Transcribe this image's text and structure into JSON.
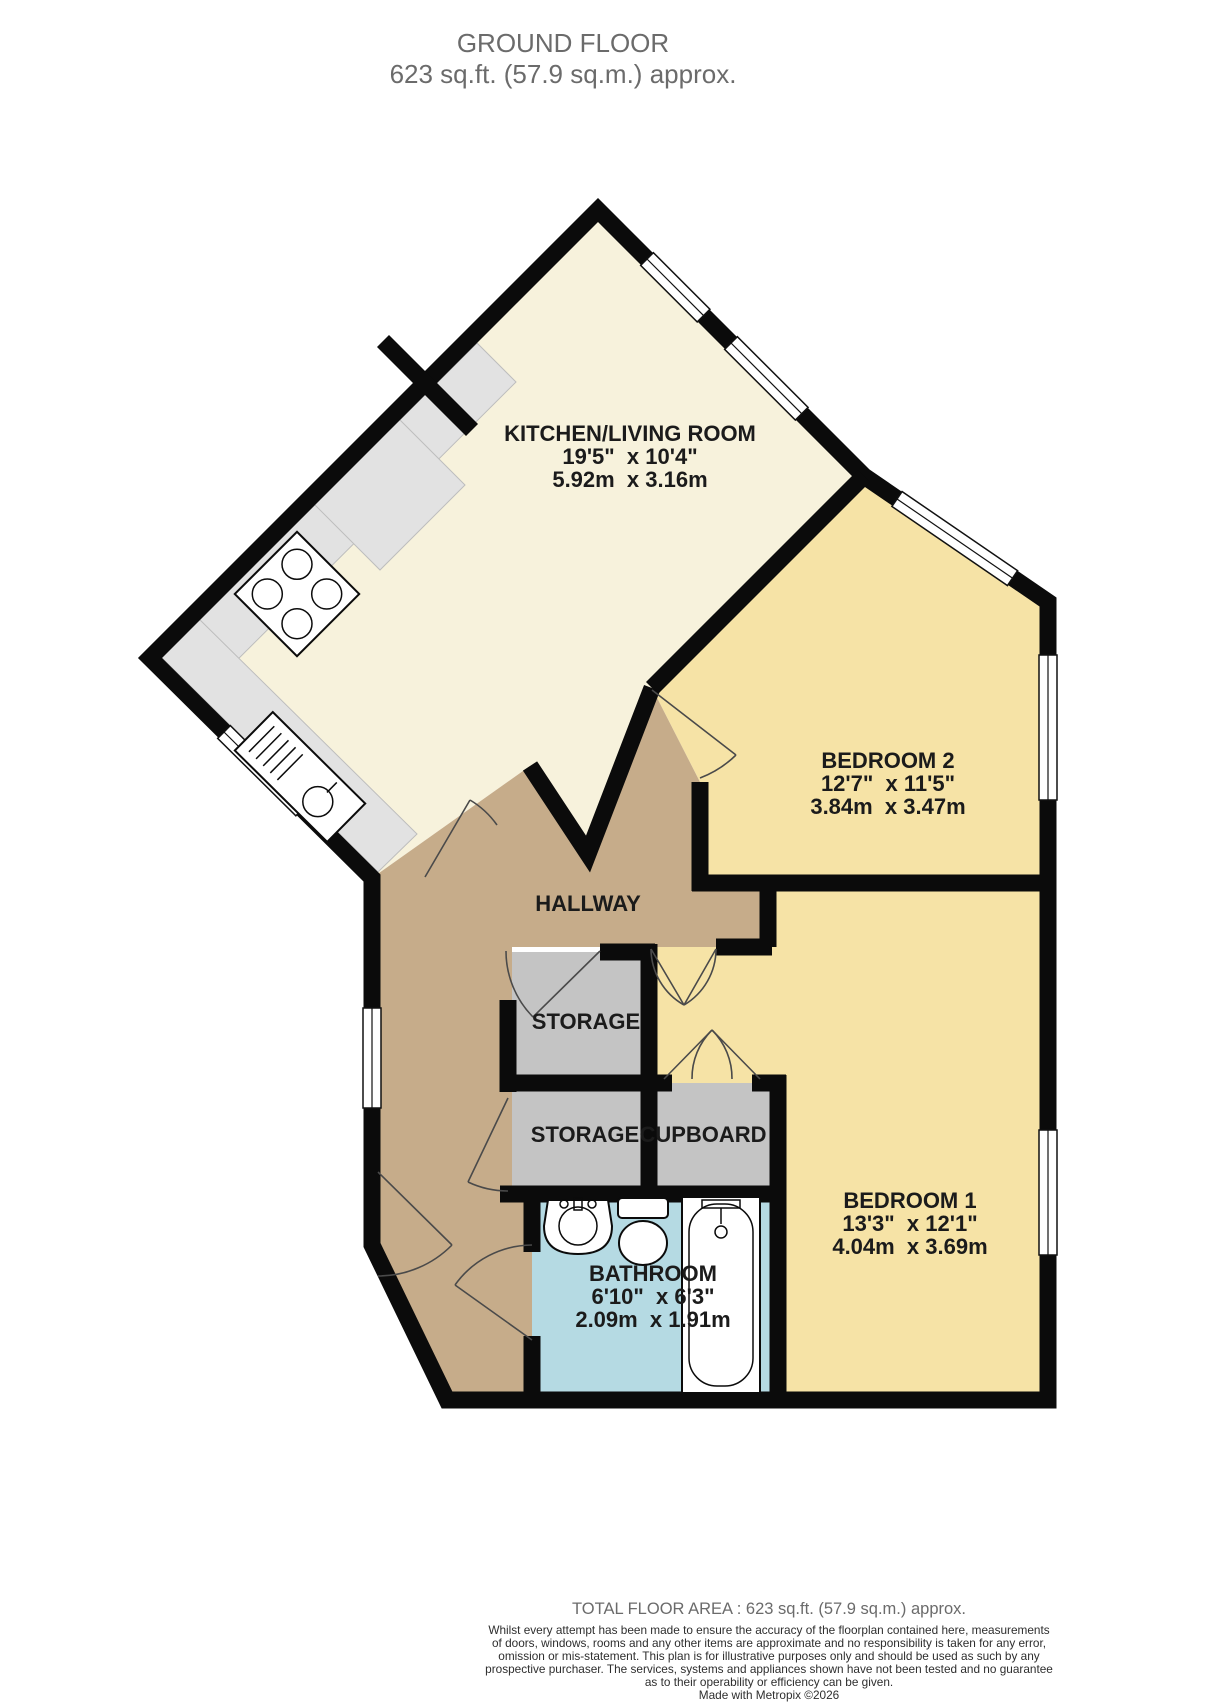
{
  "title": {
    "line1": "GROUND FLOOR",
    "line2": "623 sq.ft. (57.9 sq.m.) approx."
  },
  "rooms": {
    "kitchen_living": {
      "name": "KITCHEN/LIVING ROOM",
      "imperial": "19'5\"  x 10'4\"",
      "metric": "5.92m  x 3.16m"
    },
    "bedroom2": {
      "name": "BEDROOM 2",
      "imperial": "12'7\"  x 11'5\"",
      "metric": "3.84m  x 3.47m"
    },
    "hallway": {
      "name": "HALLWAY"
    },
    "storage1": {
      "name": "STORAGE"
    },
    "storage2": {
      "name": "STORAGE"
    },
    "cupboard": {
      "name": "CUPBOARD"
    },
    "bathroom": {
      "name": "BATHROOM",
      "imperial": "6'10\"  x 6'3\"",
      "metric": "2.09m  x 1.91m"
    },
    "bedroom1": {
      "name": "BEDROOM 1",
      "imperial": "13'3\"  x 12'1\"",
      "metric": "4.04m  x 3.69m"
    }
  },
  "footer": {
    "total": "TOTAL FLOOR AREA : 623 sq.ft. (57.9 sq.m.) approx.",
    "disclaimer_lines": [
      "Whilst every attempt has been made to ensure the accuracy of the floorplan contained here, measurements",
      "of doors, windows, rooms and any other items are approximate and no responsibility is taken for any error,",
      "omission or mis-statement. This plan is for illustrative purposes only and should be used as such by any",
      "prospective purchaser. The services, systems and appliances shown have not been tested and no guarantee",
      "as to their operability or efficiency can be given."
    ],
    "credit": "Made with Metropix ©2026"
  },
  "colors": {
    "kitchen_living_floor": "#f7f2dc",
    "bedroom_floor": "#f6e3a6",
    "hallway_floor": "#c6ac8a",
    "storage_floor": "#c4c4c4",
    "bathroom_floor": "#b5dae3",
    "counter": "#e2e2e2",
    "wall": "#0b0b0b",
    "title_text": "#6b6b6b",
    "label_text": "#1b1b1b"
  }
}
